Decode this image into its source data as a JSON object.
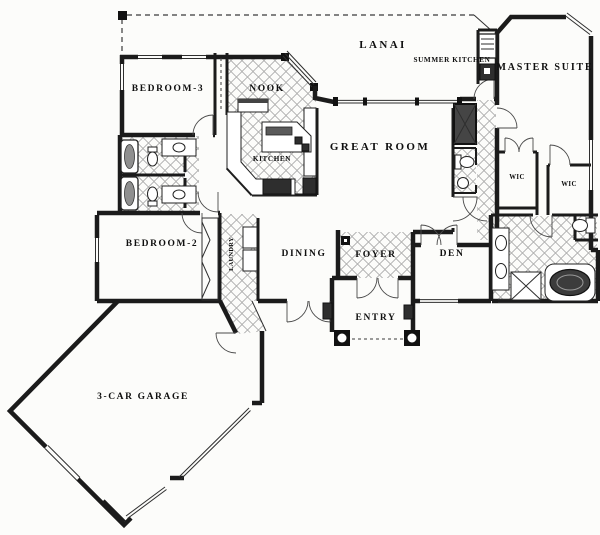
{
  "figure": {
    "kind": "single-story residential floor plan, black-and-white architectural drawing",
    "colors": {
      "ink": "#1b1b1b",
      "paper": "#fcfcfa",
      "hatch": "#a0a0a0",
      "fixture_dark": "#3c3c3c"
    }
  },
  "rooms": {
    "lanai": {
      "label": "LANAI"
    },
    "summer_kitchen": {
      "label": "SUMMER KITCHEN"
    },
    "master_suite": {
      "label": "MASTER SUITE"
    },
    "bedroom3": {
      "label": "BEDROOM-3"
    },
    "nook": {
      "label": "NOOK"
    },
    "kitchen": {
      "label": "KITCHEN"
    },
    "great_room": {
      "label": "GREAT ROOM"
    },
    "wic1": {
      "label": "WIC"
    },
    "wic2": {
      "label": "WIC"
    },
    "bedroom2": {
      "label": "BEDROOM-2"
    },
    "laundry": {
      "label": "LAUNDRY"
    },
    "dining": {
      "label": "DINING"
    },
    "foyer": {
      "label": "FOYER"
    },
    "den": {
      "label": "DEN"
    },
    "entry": {
      "label": "ENTRY"
    },
    "garage": {
      "label": "3-CAR GARAGE"
    }
  }
}
